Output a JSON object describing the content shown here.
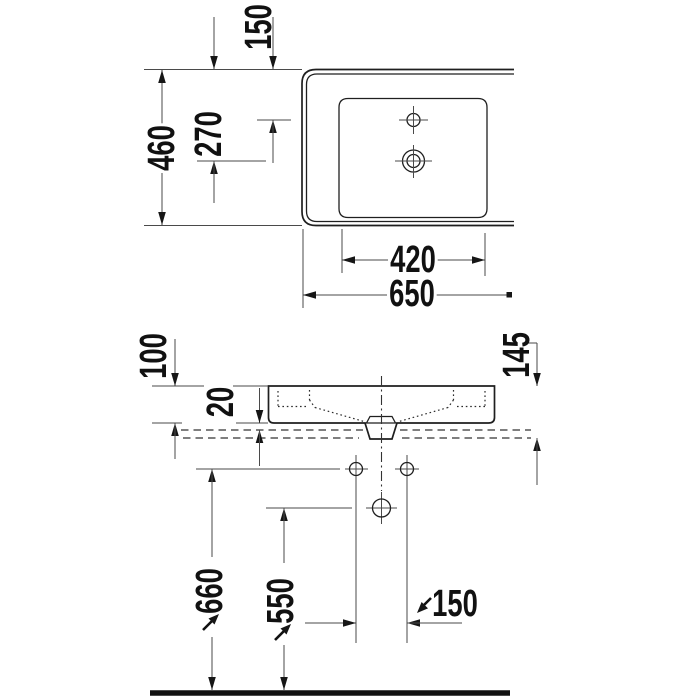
{
  "dimensions": {
    "top_view": {
      "faucet_hole_from_back": "150",
      "drain_from_back": "270",
      "depth": "460",
      "bowl_width": "420",
      "width": "650"
    },
    "front_view": {
      "front_height": "100",
      "bottom_offset": "20",
      "total_height": "145",
      "fixing_holes_height": "660",
      "drain_height": "550",
      "fixing_holes_spacing": "150"
    }
  }
}
